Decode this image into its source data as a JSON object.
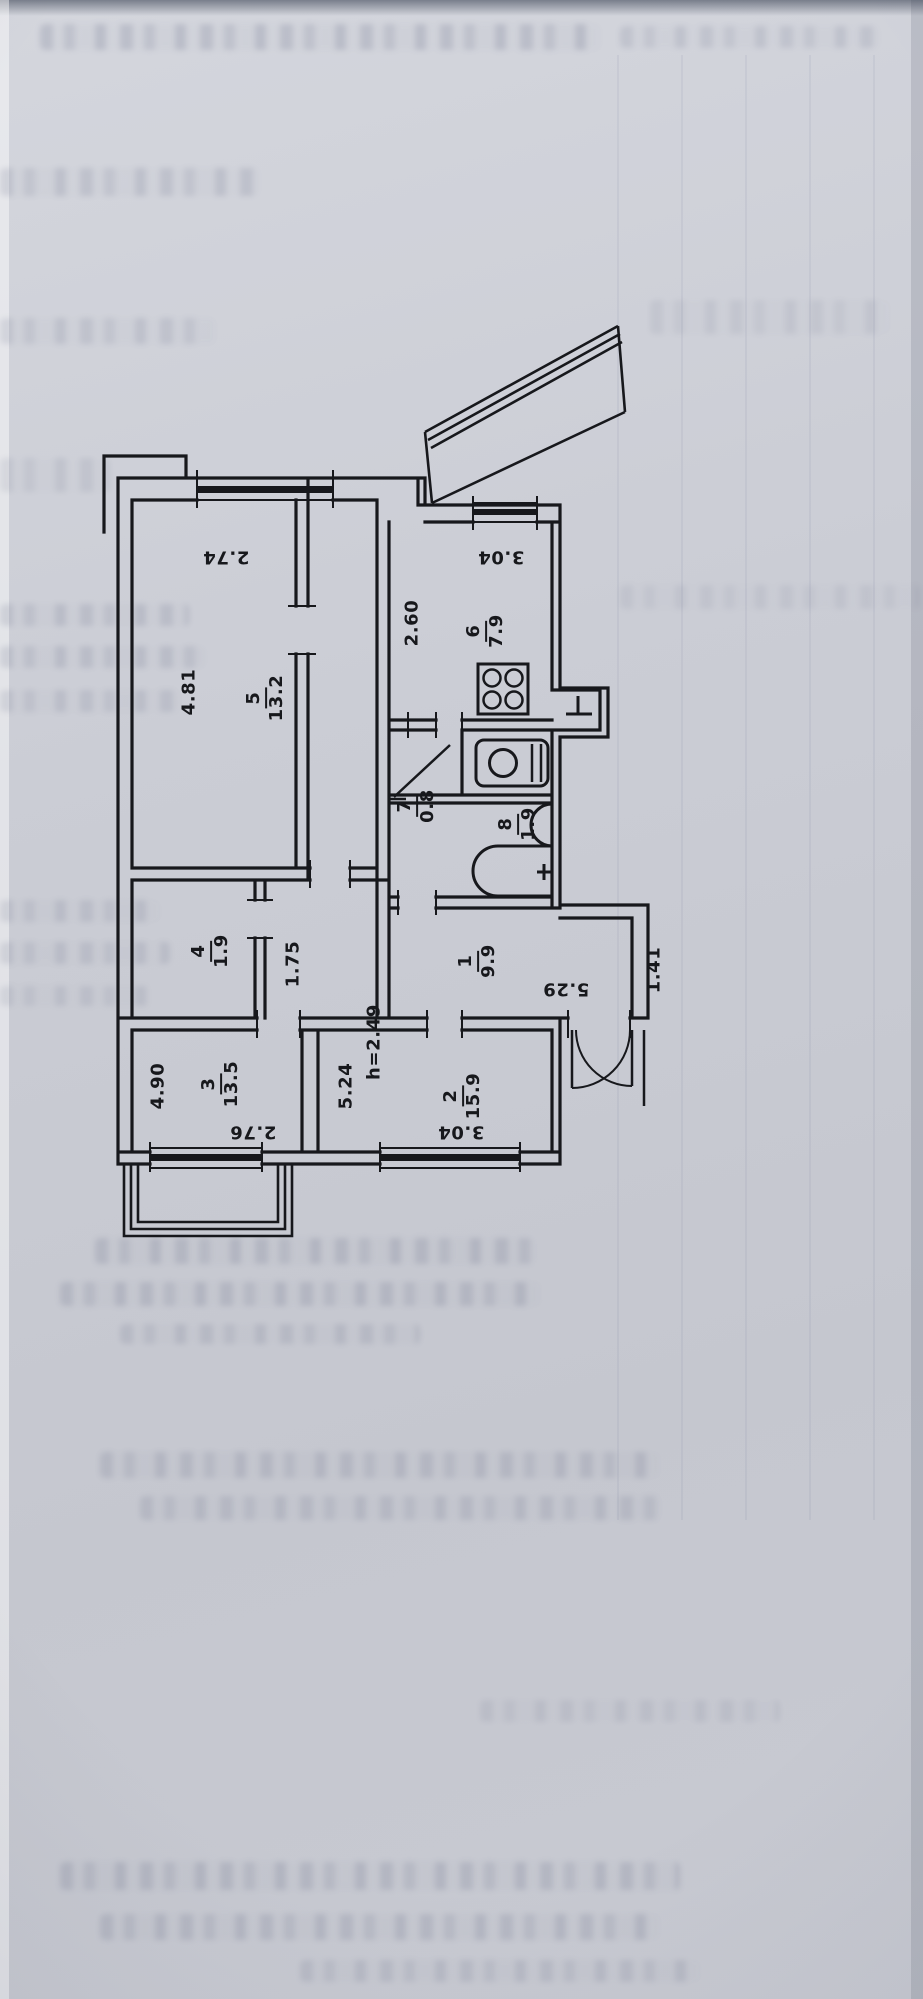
{
  "plan_type": "apartment floor plan drawing",
  "colors": {
    "paper": "#c9cbd3",
    "ink": "#17181c"
  },
  "rooms": {
    "r1": {
      "number": "1",
      "area": "9.9"
    },
    "r2": {
      "number": "2",
      "area": "15.9"
    },
    "r3": {
      "number": "3",
      "area": "13.5"
    },
    "r4": {
      "number": "4",
      "area": "1.9"
    },
    "r5": {
      "number": "5",
      "area": "13.2"
    },
    "r6": {
      "number": "6",
      "area": "7.9"
    },
    "r7": {
      "number": "7",
      "area": "0.8"
    },
    "r8": {
      "number": "8",
      "area": "1.9"
    }
  },
  "dimensions": {
    "room5_width": "2.74",
    "room5_depth": "4.81",
    "kitchen_window_width": "3.04",
    "kitchen_width": "2.60",
    "hall_length": "5.29",
    "entry_nook_width": "1.41",
    "corridor_width": "1.75",
    "room3_depth": "4.90",
    "room3_width": "2.76",
    "room2_depth": "5.24",
    "room2_width": "3.04",
    "room2_ceiling_height": "h=2.49"
  },
  "fixtures": [
    "stove",
    "kitchen-sink",
    "toilet",
    "washbasin",
    "bathtub"
  ],
  "features": [
    "balcony-top",
    "balcony-bottom",
    "entrance-door-swing",
    "wc-door-swing",
    "windows"
  ]
}
